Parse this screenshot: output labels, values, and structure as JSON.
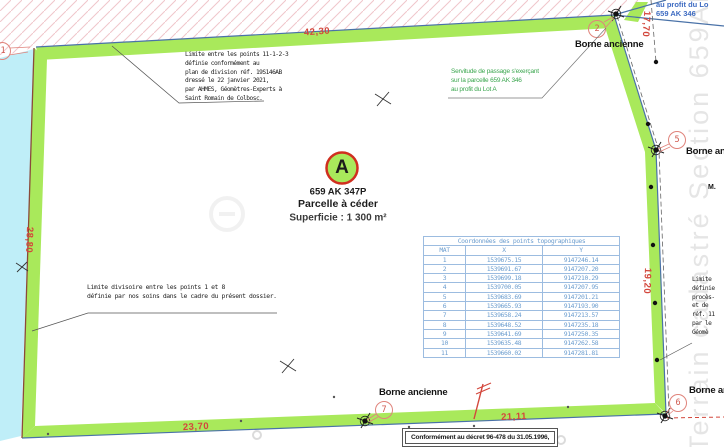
{
  "parcel": {
    "point_label": "A",
    "ref": "659 AK 347P",
    "designation": "Parcelle à céder",
    "area": "Superficie : 1 300 m²"
  },
  "labels": {
    "borne_ancienne": "Borne ancienne",
    "owner_fragment": "M."
  },
  "dimensions": {
    "top": "42,30",
    "top_right": "17,70",
    "right": "19,20",
    "left": "28,80",
    "bottom_left": "23,70",
    "bottom_right": "21,11"
  },
  "points": {
    "p1": "1",
    "p2": "2",
    "p5": "5",
    "p6": "6",
    "p7": "7"
  },
  "notes": {
    "limit_north": {
      "lines": [
        "Limite entre les points 11-1-2-3",
        "définie conformément au",
        "plan de division réf. 19S146AB",
        "dressé le 22 janvier 2021,",
        "par AHMES, Géomètres-Experts à",
        "Saint Romain de Colbosc."
      ]
    },
    "servitude": {
      "lines": [
        "Servitude de passage s'exerçant",
        "sur la parcelle 659 AK 346",
        "au profit du Lot A"
      ]
    },
    "limit_division": {
      "lines": [
        "Limite divisoire entre les points 1 et 8",
        "définie par nos soins dans le cadre du présent dossier."
      ]
    },
    "right_clipped": {
      "lines": [
        "Limite",
        "définie",
        "procès-",
        "et de",
        "réf. 11",
        "par le",
        "Géomè"
      ]
    },
    "top_right_blue": {
      "lines": [
        "au profit du Lo",
        "659 AK 346"
      ]
    },
    "decree": "Conformément au décret 96-478 du 31.05.1996,"
  },
  "watermark": {
    "vertical_text": "Terrain cadastré Section 659AK n"
  },
  "table": {
    "title": "Coordonnées des points topographiques",
    "columns": [
      "MAT",
      "X",
      "Y"
    ],
    "rows": [
      {
        "mat": "1",
        "x": "1539675.15",
        "y": "9147246.14"
      },
      {
        "mat": "2",
        "x": "1539691.67",
        "y": "9147207.20"
      },
      {
        "mat": "3",
        "x": "1539699.18",
        "y": "9147210.29"
      },
      {
        "mat": "4",
        "x": "1539700.05",
        "y": "9147207.95"
      },
      {
        "mat": "5",
        "x": "1539683.69",
        "y": "9147201.21"
      },
      {
        "mat": "6",
        "x": "1539665.93",
        "y": "9147193.90"
      },
      {
        "mat": "7",
        "x": "1539658.24",
        "y": "9147213.57"
      },
      {
        "mat": "8",
        "x": "1539648.52",
        "y": "9147235.18"
      },
      {
        "mat": "9",
        "x": "1539641.69",
        "y": "9147250.35"
      },
      {
        "mat": "10",
        "x": "1539635.48",
        "y": "9147262.58"
      },
      {
        "mat": "11",
        "x": "1539660.02",
        "y": "9147281.81"
      }
    ]
  },
  "colors": {
    "band_green": "#a9e95b",
    "band_cyan": "#bfeef8",
    "dim_red": "#d3473c",
    "table_blue": "#6d9ecf",
    "servitude_green": "#3aa64e",
    "point_circle_red": "#e0837b"
  }
}
